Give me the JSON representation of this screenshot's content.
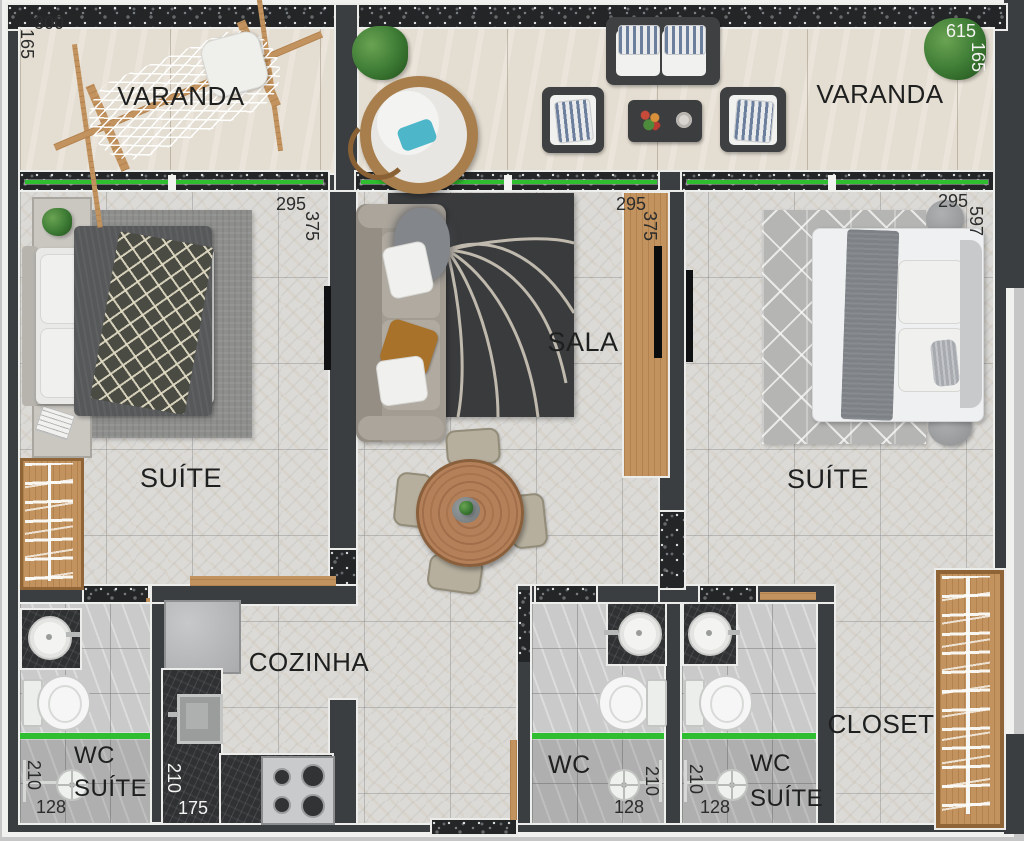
{
  "plan_title": "Apartment floor plan",
  "rooms": {
    "varanda_left": {
      "label": "VARANDA",
      "dim_w": "300",
      "dim_h": "165"
    },
    "varanda_right": {
      "label": "VARANDA",
      "dim_w": "615",
      "dim_h": "165"
    },
    "suite_left": {
      "label": "SUÍTE",
      "dim_w": "295",
      "dim_h": "375"
    },
    "sala": {
      "label": "SALA",
      "dim_w": "295",
      "dim_h": "375"
    },
    "suite_right": {
      "label": "SUÍTE",
      "dim_w": "295",
      "dim_h": "597"
    },
    "cozinha": {
      "label": "COZINHA",
      "dim_w": "175",
      "dim_h": "210"
    },
    "wc_suite_left": {
      "label_line1": "WC",
      "label_line2": "SUÍTE",
      "dim_w": "128",
      "dim_h": "210"
    },
    "wc": {
      "label": "WC",
      "dim_w": "128",
      "dim_h": "210"
    },
    "wc_suite_right": {
      "label_line1": "WC",
      "label_line2": "SUÍTE",
      "dim_w": "128",
      "dim_h": "210"
    },
    "closet": {
      "label": "CLOSET"
    }
  },
  "colors": {
    "wall": "#3b3e40",
    "glass_partition_green": "#2fbe2f",
    "wood": "#c2935f",
    "balcony_floor": "#e4ddd1",
    "room_floor": "#dbdad7",
    "bathroom_floor": "#c9cac9",
    "counter_granite": "#2f3133",
    "outer_margin": "#c6c6c6"
  }
}
